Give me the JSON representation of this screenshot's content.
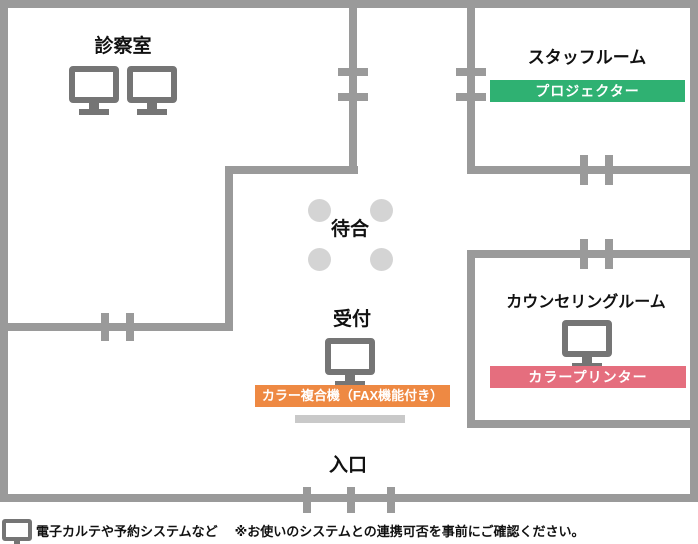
{
  "rooms": {
    "examination": {
      "name": "診察室"
    },
    "staff": {
      "name": "スタッフルーム",
      "equipment_label": "プロジェクター"
    },
    "waiting": {
      "name": "待合"
    },
    "reception": {
      "name": "受付",
      "equipment_label": "カラー複合機（FAX機能付き）"
    },
    "counseling": {
      "name": "カウンセリングルーム",
      "equipment_label": "カラープリンター"
    },
    "entrance": {
      "name": "入口"
    }
  },
  "legend": {
    "device_label": "電子カルテや予約システムなど",
    "note": "※お使いのシステムとの連携可否を事前にご確認ください。"
  },
  "colors": {
    "wall": "#9a9a9a",
    "device_icon": "#757575",
    "chair": "#d4d4d4",
    "counter": "#c9c9c9",
    "projector_badge": "#2fb172",
    "copier_badge": "#ee8943",
    "printer_badge": "#e56e7e",
    "badge_text": "#ffffff"
  }
}
